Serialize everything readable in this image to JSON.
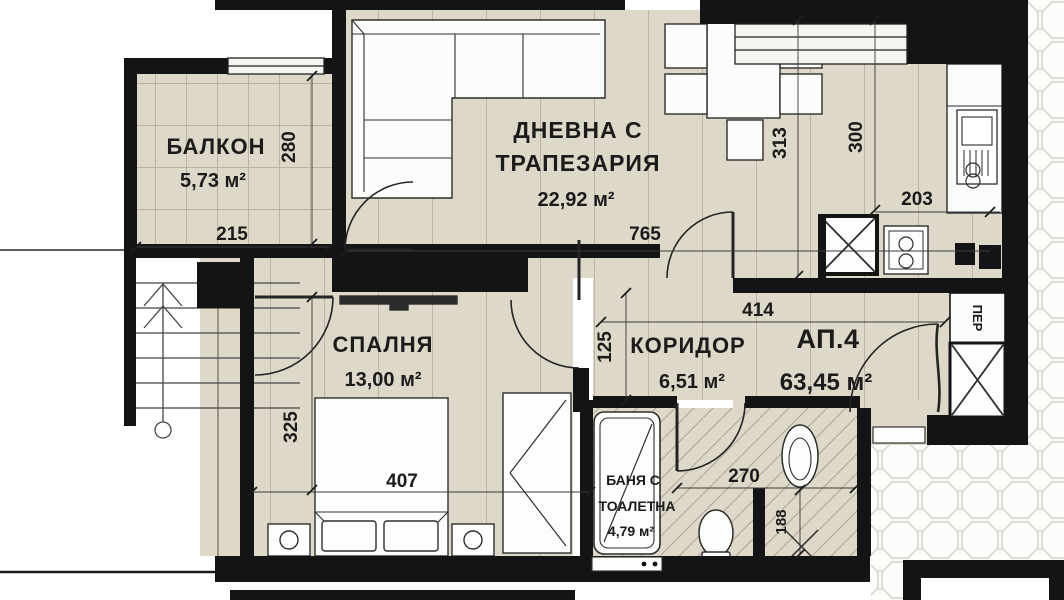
{
  "plan": {
    "rooms": {
      "balcony": {
        "label": "БАЛКОН",
        "area": "5,73 м²"
      },
      "living": {
        "label_line1": "ДНЕВНА С",
        "label_line2": "ТРАПЕЗАРИЯ",
        "area": "22,92 м²"
      },
      "bedroom": {
        "label": "СПАЛНЯ",
        "area": "13,00 м²"
      },
      "corridor": {
        "label": "КОРИДОР",
        "area": "6,51 м²"
      },
      "bathroom": {
        "label_line1": "БАНЯ С",
        "label_line2": "ТОАЛЕТНА",
        "area": "4,79 м²"
      },
      "apartment": {
        "label": "АП.4",
        "area": "63,45 м²"
      },
      "closet": {
        "label": "ПЕР"
      }
    },
    "dims": {
      "balcony_w": "215",
      "balcony_h": "280",
      "living_w": "765",
      "kitchen_h_left": "313",
      "kitchen_h_right": "300",
      "kitchen_w": "203",
      "corridor_w": "414",
      "corridor_h": "125",
      "bedroom_h": "325",
      "bedroom_w": "407",
      "bathroom_w": "270",
      "niche_h": "188"
    },
    "colors": {
      "floor": "#ded8c9",
      "wall": "#141414",
      "tile_line": "#d2d2cb"
    }
  }
}
